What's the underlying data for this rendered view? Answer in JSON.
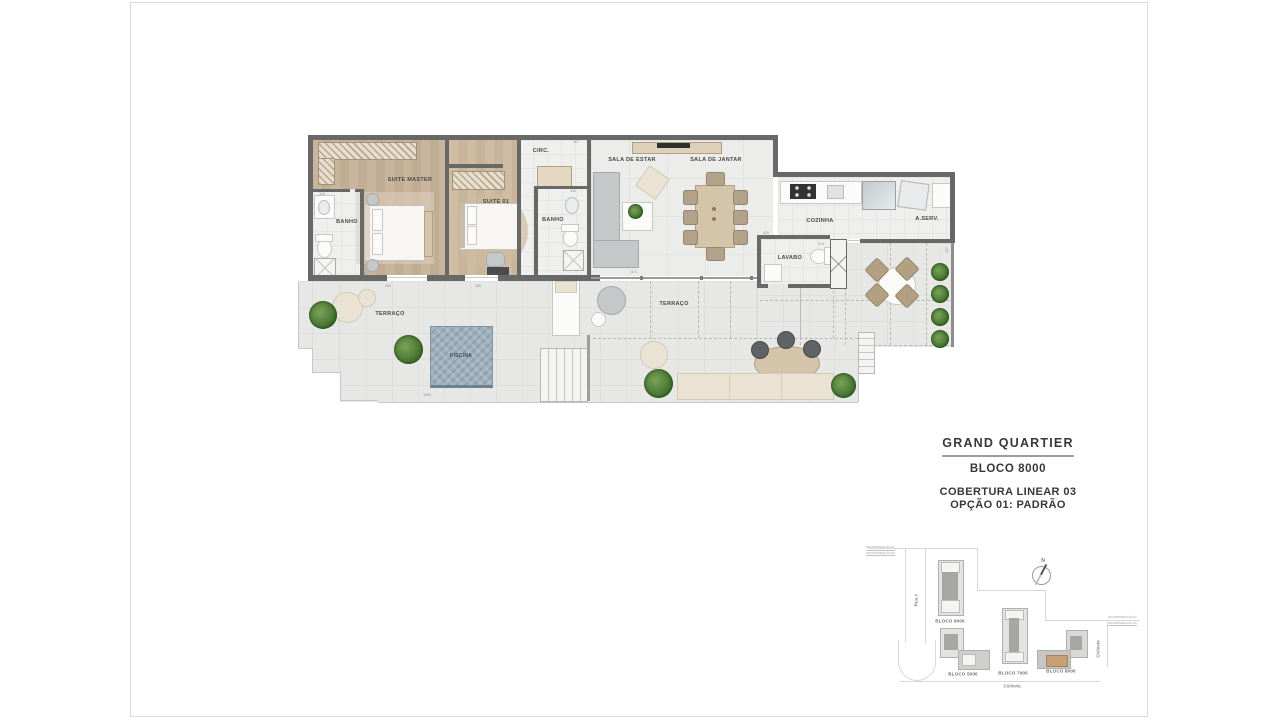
{
  "title_block": {
    "project": "GRAND QUARTIER",
    "block": "BLOCO 8000",
    "option_line1": "COBERTURA LINEAR 03",
    "option_line2": "OPÇÃO 01: PADRÃO"
  },
  "floor_plan": {
    "rooms": {
      "suite_master": "SUITE MASTER",
      "suite_01": "SUITE 01",
      "banho_master": "BANHO",
      "banho_suite": "BANHO",
      "circ": "CIRC.",
      "sala_de_estar": "SALA DE ESTAR",
      "sala_de_jantar": "SALA DE JANTAR",
      "cozinha": "COZINHA",
      "area_servico": "A.SERV.",
      "lavabo": "LAVABO",
      "terraco_1": "TERRAÇO",
      "terraco_2": "TERRAÇO",
      "piscina": "PISCINA"
    },
    "dimensions": {
      "banho_width": "145",
      "suite_master_door": "260",
      "suite_01_door": "260",
      "banho_suite_width": "130",
      "circ_width": "267",
      "lavabo_width": "420",
      "lavabo_depth": "213",
      "terraco_length": "1425",
      "terraco_right_depth": "337",
      "sala_door": "871"
    }
  },
  "site_plan": {
    "street_rua_a": "Rua A",
    "street_ciclovia_bottom": "Ciclovia",
    "street_ciclovia_right": "Ciclovia",
    "north_label": "N",
    "blocks": {
      "bloco_6000": "BLOCO 6000",
      "bloco_5000": "BLOCO 5000",
      "bloco_7000": "BLOCO 7000",
      "bloco_8000": "BLOCO 8000"
    },
    "incorporacao_top_1": "INCORPORAÇÃO 01",
    "incorporacao_top_2": "INCORPORAÇÃO 02",
    "incorporacao_right_1": "INCORPORAÇÃO 01",
    "incorporacao_right_2": "INCORPORAÇÃO 02"
  },
  "colors": {
    "wall": "#686868",
    "wood_floor": "#c7b49c",
    "tile_floor": "#efefed",
    "terrace_floor": "#e7e7e5",
    "pool": "#9db0bb",
    "plant": "#4b7a36",
    "highlight_block": "#c79f76"
  }
}
